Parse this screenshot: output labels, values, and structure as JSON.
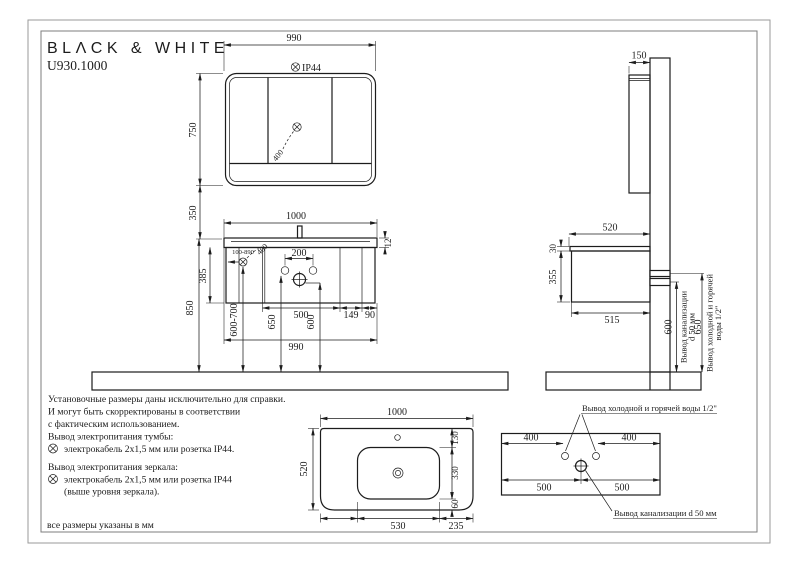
{
  "brand": "BLΛCK & WHITE",
  "model": "U930.1000",
  "d": {
    "mirror_w": "990",
    "mirror_h": "750",
    "mirror_cable": "400",
    "gap": "350",
    "van_w": "1000",
    "ct": "12",
    "body_h": "385",
    "floor": "850",
    "outlet_range": "100-890",
    "van_cable": "400",
    "faucet": "200",
    "outlet_v": "600-700",
    "water_v": "650",
    "drain_v": "600",
    "s500": "500",
    "s149": "149",
    "s90": "90",
    "van_b": "990",
    "side_d": "150",
    "side_top": "520",
    "side_ct": "30",
    "side_h": "355",
    "side_b": "515",
    "side_drain": "600",
    "side_water": "650",
    "sink_w": "1000",
    "sink_d": "520",
    "sink_f": "130",
    "sink_m": "330",
    "sink_b": "60",
    "sink_bw": "530",
    "sink_br": "235",
    "w400l": "400",
    "w400r": "400",
    "w500l": "500",
    "w500r": "500"
  },
  "t": {
    "ip44": "IP44",
    "water_full": "Вывод холодной и горячей воды 1/2\"",
    "drain_full": "Вывод канализации d 50 мм",
    "side_drain1": "Вывод канализации",
    "side_drain2": "d 50 мм",
    "side_water1": "Вывод холодной и горячей",
    "side_water2": "воды 1/2\"",
    "notes": [
      "Установочные размеры даны исключительно для справки.",
      "И могут быть скорректированы в соответствии",
      "с фактическим использованием.",
      "Вывод электропитания тумбы:",
      "электрокабель 2х1,5 мм или розетка IP44.",
      "Вывод электропитания зеркала:",
      "электрокабель 2х1,5 мм или розетка IP44",
      "(выше уровня зеркала)."
    ],
    "footer": "все размеры указаны в мм"
  }
}
